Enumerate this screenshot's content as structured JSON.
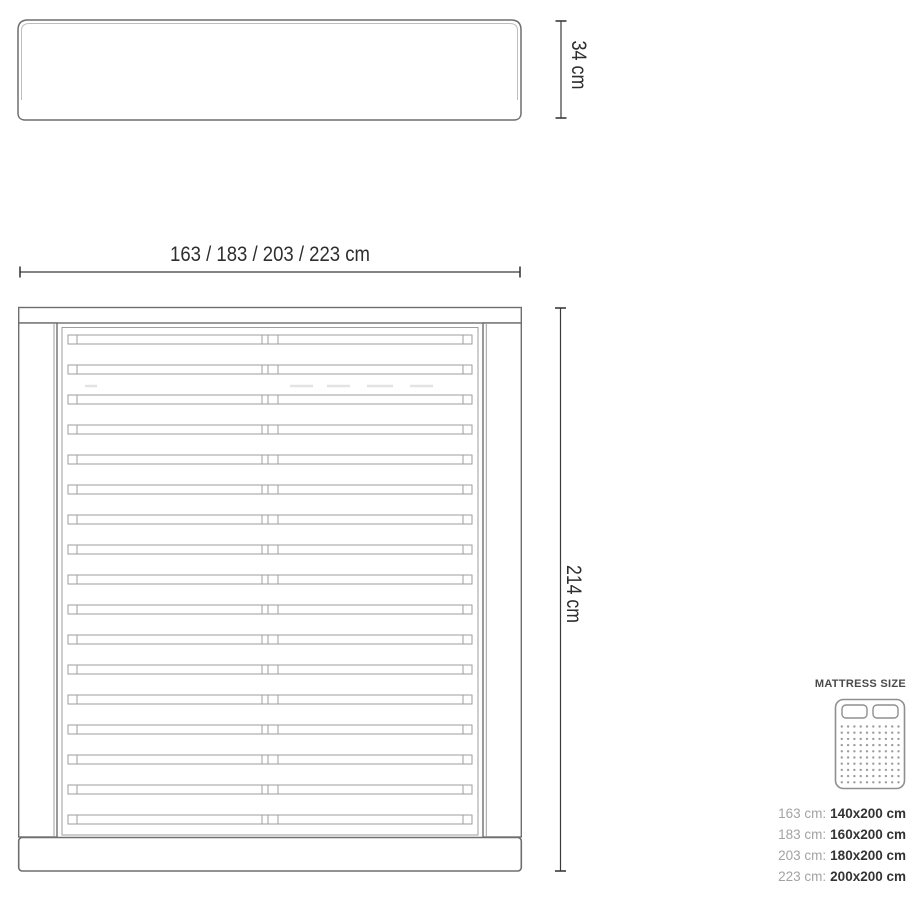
{
  "diagram": {
    "headboard_height_label": "34 cm",
    "frame_width_label": "163 / 183 / 203 / 223 cm",
    "frame_length_label": "214 cm",
    "slat_count": 17,
    "colors": {
      "outline": "#6e6e6e",
      "outline_light": "#bdbdbd",
      "slat": "#9e9e9e",
      "shadow": "#c9c9c9",
      "ghost": "#e3e3e3",
      "dimension": "#3a3a3a",
      "text": "#2e2e2e",
      "legend_gray": "#a3a3a3",
      "legend_dark": "#333333",
      "icon": "#8f8f8f"
    }
  },
  "legend": {
    "title": "MATTRESS SIZE",
    "icon": "mattress-top-view-icon",
    "rows": [
      {
        "frame": "163 cm:",
        "mattress": "140x200 cm"
      },
      {
        "frame": "183 cm:",
        "mattress": "160x200 cm"
      },
      {
        "frame": "203 cm:",
        "mattress": "180x200 cm"
      },
      {
        "frame": "223 cm:",
        "mattress": "200x200 cm"
      }
    ]
  }
}
